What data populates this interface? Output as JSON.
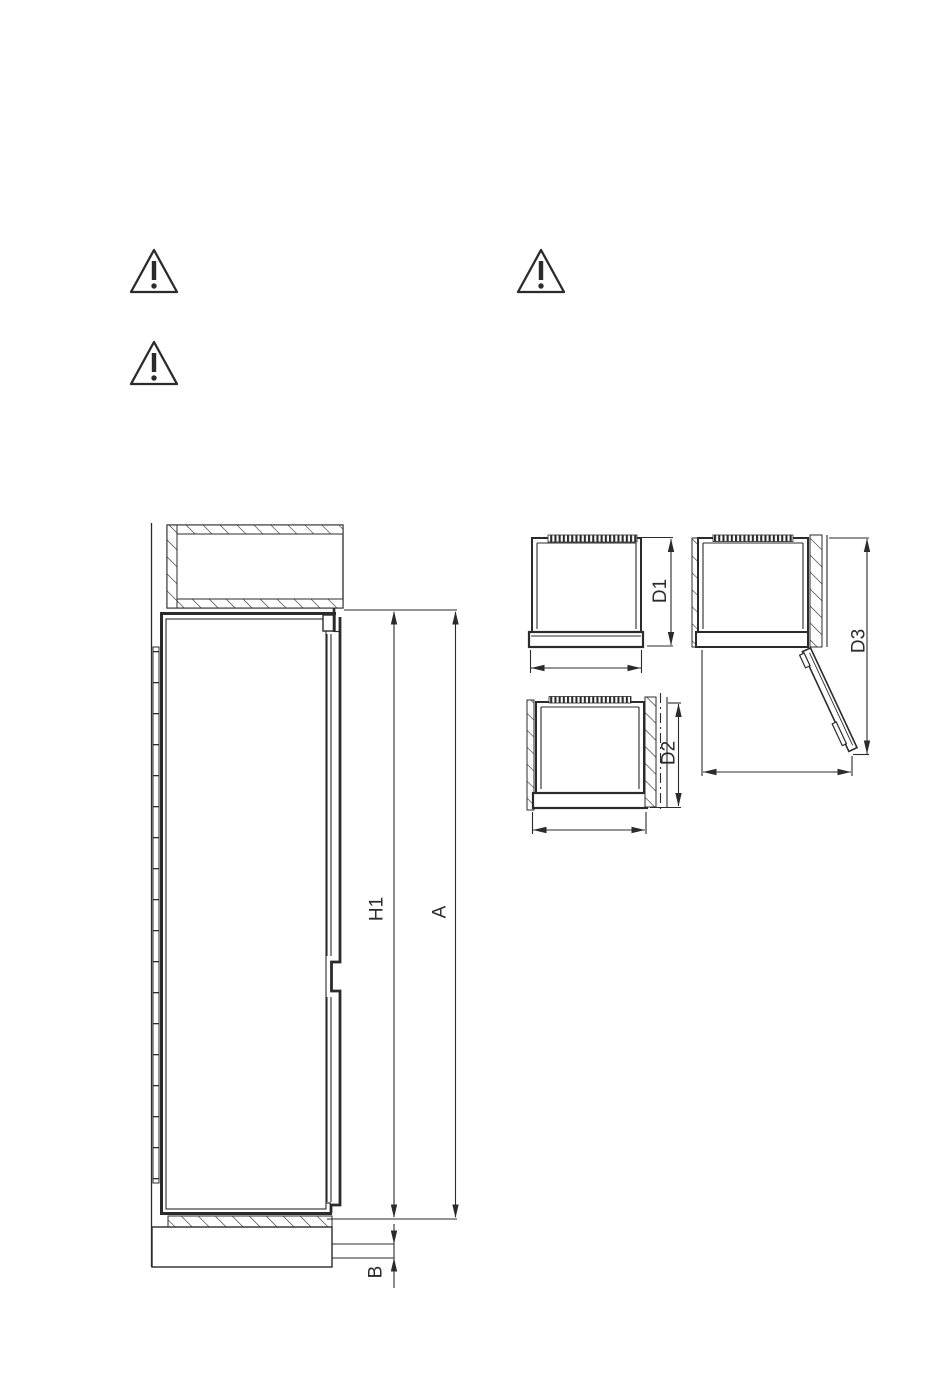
{
  "page": {
    "background_color": "#ffffff",
    "line_color": "#2b2b2b"
  },
  "icons": {
    "warning": "warning-triangle-icon",
    "warning_count": 3
  },
  "side_view": {
    "description_role": "built-in refrigerator side section with niche cabinet, plinth and dimension lines",
    "labels": {
      "h1": "H1",
      "a": "A",
      "b": "B"
    }
  },
  "top_views": {
    "description_role": "three top-view depth diagrams: door closed, against wall with centerline, door open",
    "labels": {
      "d1": "D1",
      "d2": "D2",
      "d3": "D3"
    }
  }
}
